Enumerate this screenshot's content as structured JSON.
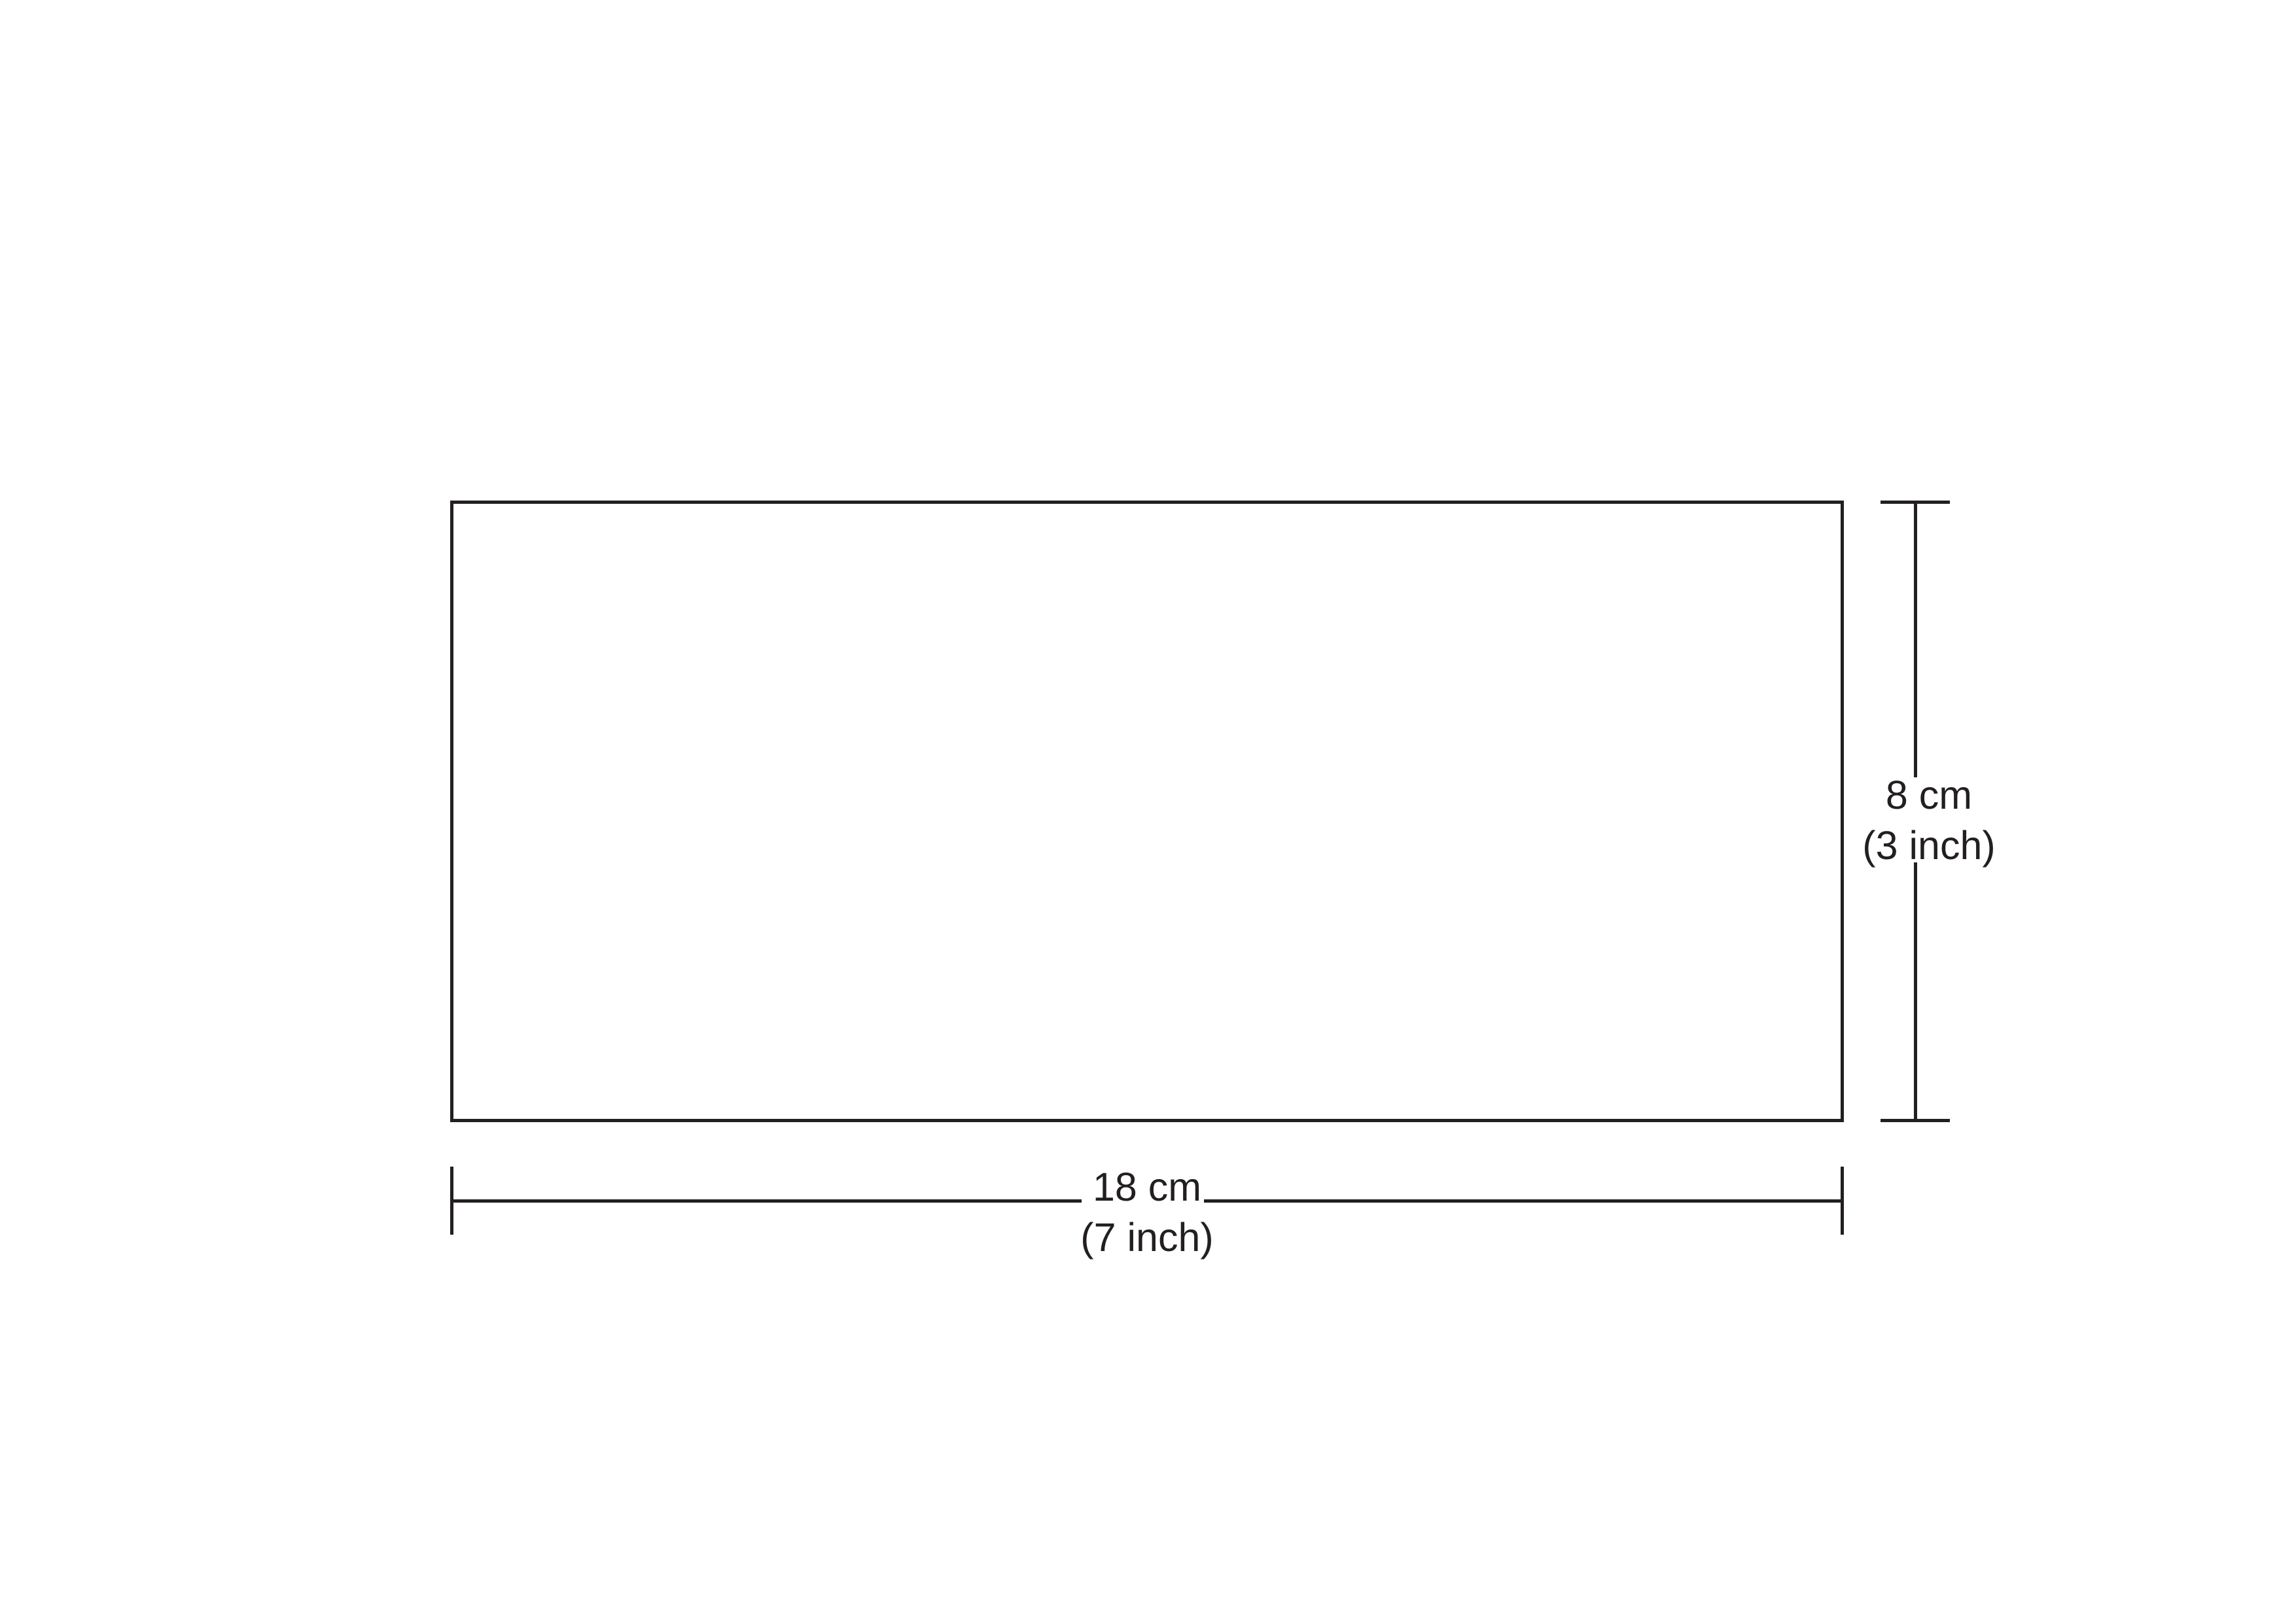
{
  "figure": {
    "shape": "rectangle",
    "background_color": "#ffffff",
    "stroke_color": "#231f20"
  },
  "dimensions": {
    "height": {
      "metric": "8 cm",
      "imperial": "(3 inch)"
    },
    "width": {
      "metric": "18 cm",
      "imperial": "(7 inch)"
    }
  }
}
